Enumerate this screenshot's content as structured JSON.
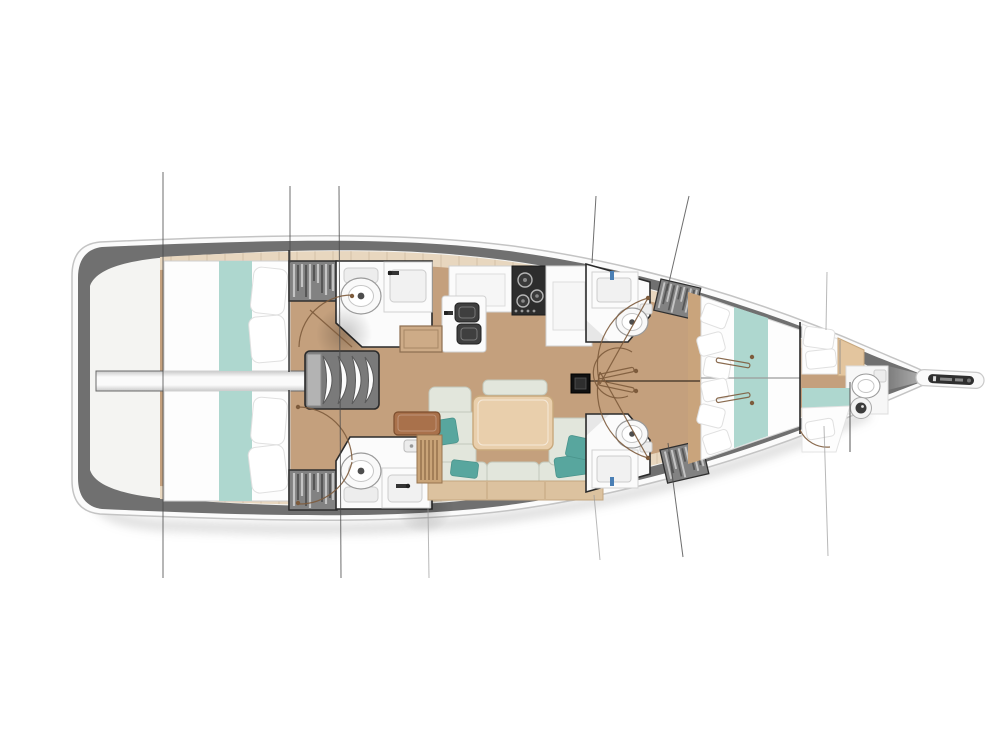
{
  "palette": {
    "hull-rim": "#707070",
    "hull-outer": "#fbfbfb",
    "deck": "#f4f4f2",
    "liner": "#e8d7bf",
    "wood": "#c4a07d",
    "white-fixture": "#fbfbfb",
    "bed-white": "#fdfdfd",
    "teal": "#aed7cf",
    "pillow-teal": "#58a69e",
    "cushion": "#e2e6dc",
    "table-wood": "#e9cfac",
    "rail-wood": "#dcc29f",
    "seat-brown": "#a9714b",
    "desk-wood": "#c9a478",
    "appliance": "#2d2d2d",
    "outline-dark": "#2b2b2b",
    "door-brown": "#7d5b3c",
    "wardrobe-gray": "#828282",
    "rig-line": "#4a4a4a"
  },
  "components": [
    "hull",
    "bowsprit",
    "rig-lines",
    "engine-compartment",
    "companionway-stairs",
    "aft-cabin-port",
    "aft-cabin-starboard",
    "aft-head-port",
    "aft-head-starboard",
    "wardrobe-aft-port",
    "wardrobe-aft-starboard",
    "galley",
    "salon-sofa",
    "salon-table",
    "nav-seat",
    "nav-desk",
    "floor-locker",
    "mid-head-port",
    "mid-head-starboard",
    "wardrobe-mid-port",
    "wardrobe-mid-starboard",
    "forward-cabin",
    "bow-head",
    "mast-foot",
    "centerline"
  ],
  "fixtures": [
    "toilet",
    "sink",
    "double-sink",
    "stove",
    "shower-drain",
    "bed",
    "pillow",
    "table",
    "sofa"
  ]
}
